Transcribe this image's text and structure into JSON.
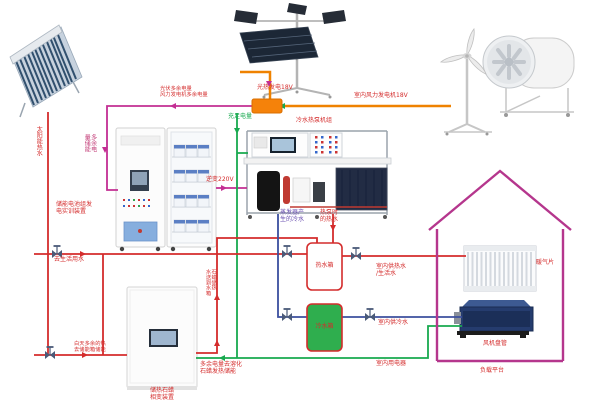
{
  "colors": {
    "pipe_hot": "#d42c2c",
    "pipe_cold": "#3b4f9e",
    "wire_surplus": "#c32e93",
    "wire_main": "#ef8200",
    "wire_sufficient": "#18a94f",
    "house_outline": "#b5368d",
    "cold_tank_fill": "#2fae4e"
  },
  "labels": {
    "solar_hot_water": "太阳能热水",
    "pv_surplus": "光伏多余电量\n风力发电机多余电量",
    "pv_gen": "光热发电18V",
    "wind_gen": "室内风力发电机18V",
    "surplus_store": "多余电\n量储能",
    "battery_device": "储能电池组发\n电实训装置",
    "enough_power": "充足电量",
    "inverter": "逆变220V",
    "heatpump_unit": "冷水热泵机组",
    "evap_cold": "蒸发器产\n生的冷水",
    "hp_hot": "热泵时\n的热水",
    "hot_tank": "热水箱",
    "cold_tank": "冷水箱",
    "to_domestic": "去生活用水",
    "day_surplus": "白天多余的热\n去储能箱储能",
    "paraffin_to_tank": "石蜡储热\n水送到水箱",
    "surplus_melt": "多余电量去溶化\n石蜡发热储能",
    "paraffin_device": "储热石蜡\n相变装置",
    "indoor_hot": "室内供热水\n/生活水",
    "indoor_cold": "室内供冷水",
    "indoor_appliance": "室内用电器",
    "radiator": "暖气片",
    "fan_coil": "风机盘管",
    "load_platform": "负载平台"
  }
}
